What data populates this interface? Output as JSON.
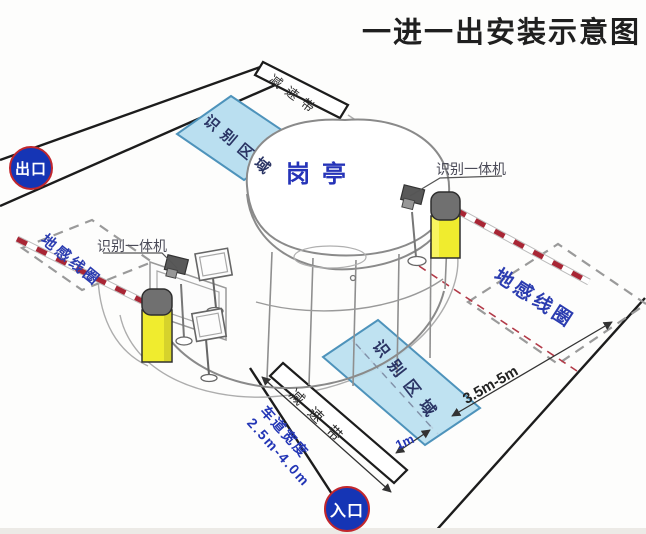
{
  "title": "一进一出安装示意图",
  "badges": {
    "exit": "出口",
    "entrance": "入口"
  },
  "booth": {
    "label": "岗亭"
  },
  "exit_lane": {
    "recognition_area": "识别区域",
    "ground_loop": "地感线圈",
    "reader": "识别一体机",
    "speed_bump": "减速带"
  },
  "entry_lane": {
    "recognition_area": "识别区域",
    "ground_loop": "地感线圈",
    "reader": "识别一体机",
    "speed_bump": "减速带",
    "dimensions": {
      "loop_to_area": "3.5m-5m",
      "stop_line_offset": "1m",
      "lane_width_title": "车道宽度",
      "lane_width_range": "2.5m-4.0m"
    }
  },
  "colors": {
    "badge_blue": "#1535b5",
    "badge_ring": "#c1272d",
    "area_fill": "#badff0",
    "area_stroke": "#4e93bb",
    "blue_text": "#2b3cb0",
    "arm_red": "#a82635",
    "machine_yellow": "#f0ec2e",
    "machine_cap_gray": "#707070",
    "lane_line_black": "#1c1c1c",
    "loop_dash_gray": "#9a9a9a",
    "centerline_red": "#b23a48"
  }
}
